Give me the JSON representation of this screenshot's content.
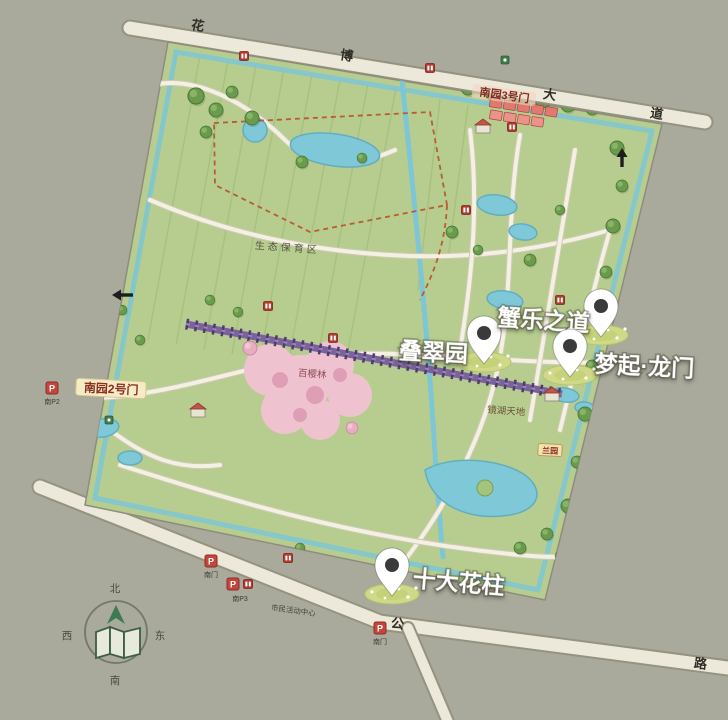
{
  "map": {
    "title_hint": "park illustrated map",
    "colors": {
      "background": "#a9aa9c",
      "park_green": "#b7cd8f",
      "water": "#7fc8d7",
      "road": "#ece8da",
      "corridor_purple": "#7a639c",
      "cherry_pink": "#eec3cf",
      "badge_red": "#c4463b",
      "pin_white": "#ffffff",
      "callout_text": "#ffffff"
    },
    "callouts": {
      "diecui": {
        "label": "叠翠园"
      },
      "xiele": {
        "label": "蟹乐之道"
      },
      "mengqi": {
        "label": "梦起·龙门"
      },
      "huazhu": {
        "label": "十大花柱"
      }
    },
    "gates": {
      "gate2": {
        "label": "南园2号门"
      },
      "gate3": {
        "label": "南园3号门"
      }
    },
    "areas": {
      "eco": {
        "label": "生态保育区"
      },
      "cherry": {
        "label": "百樱林"
      },
      "jinghu": {
        "label": "镜湖天地"
      },
      "lanyuan": {
        "label": "兰园"
      },
      "civic": {
        "label": "市民活动中心"
      }
    },
    "road_labels": {
      "top_1": "花",
      "top_2": "博",
      "top_3": "大",
      "top_4": "道",
      "bottom_1": "公",
      "bottom_2": "路"
    },
    "parking": {
      "letter": "P",
      "p2": {
        "label": "南P2"
      },
      "south_gate_a": {
        "label": "南门"
      },
      "p3": {
        "label": "南P3"
      },
      "south_gate_b": {
        "label": "南门"
      }
    },
    "compass": {
      "north": "北",
      "south": "南",
      "west": "西",
      "east": "东"
    }
  }
}
